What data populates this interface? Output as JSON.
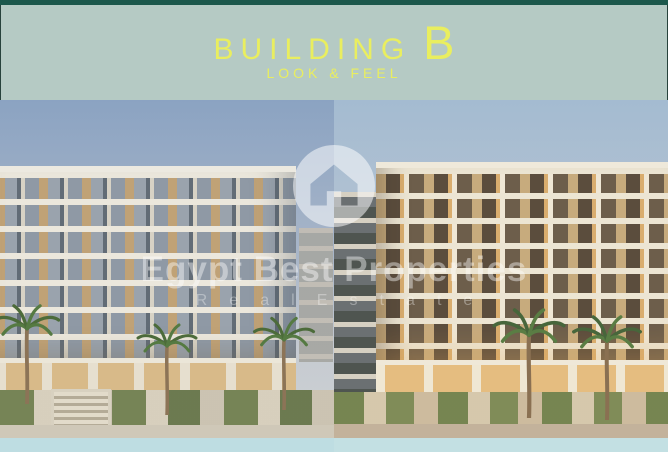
{
  "header": {
    "title_main": "BUILDING",
    "title_letter": "B",
    "subtitle": "LOOK & FEEL"
  },
  "watermark": {
    "brand": "Egypt Best Properties",
    "tagline": "R e a l   E s t a t e",
    "logo_icon": "house-logo-icon"
  },
  "colors": {
    "top_bar_teal": "#1c584c",
    "header_background_sage": "#b5cac4",
    "title_accent_yellow": "#e9ee5f",
    "left_sky_blue": "#8ba3c2",
    "right_sky_blue": "#a4bbd1",
    "facade_tan": "#c0a276",
    "facade_slab_white": "#ece9e0",
    "lit_window_amber": "#d9ad6e",
    "greenery_olive": "#6e7e4e",
    "water_strip_left": "#bedde2",
    "water_strip_right": "#c3e0e3"
  }
}
